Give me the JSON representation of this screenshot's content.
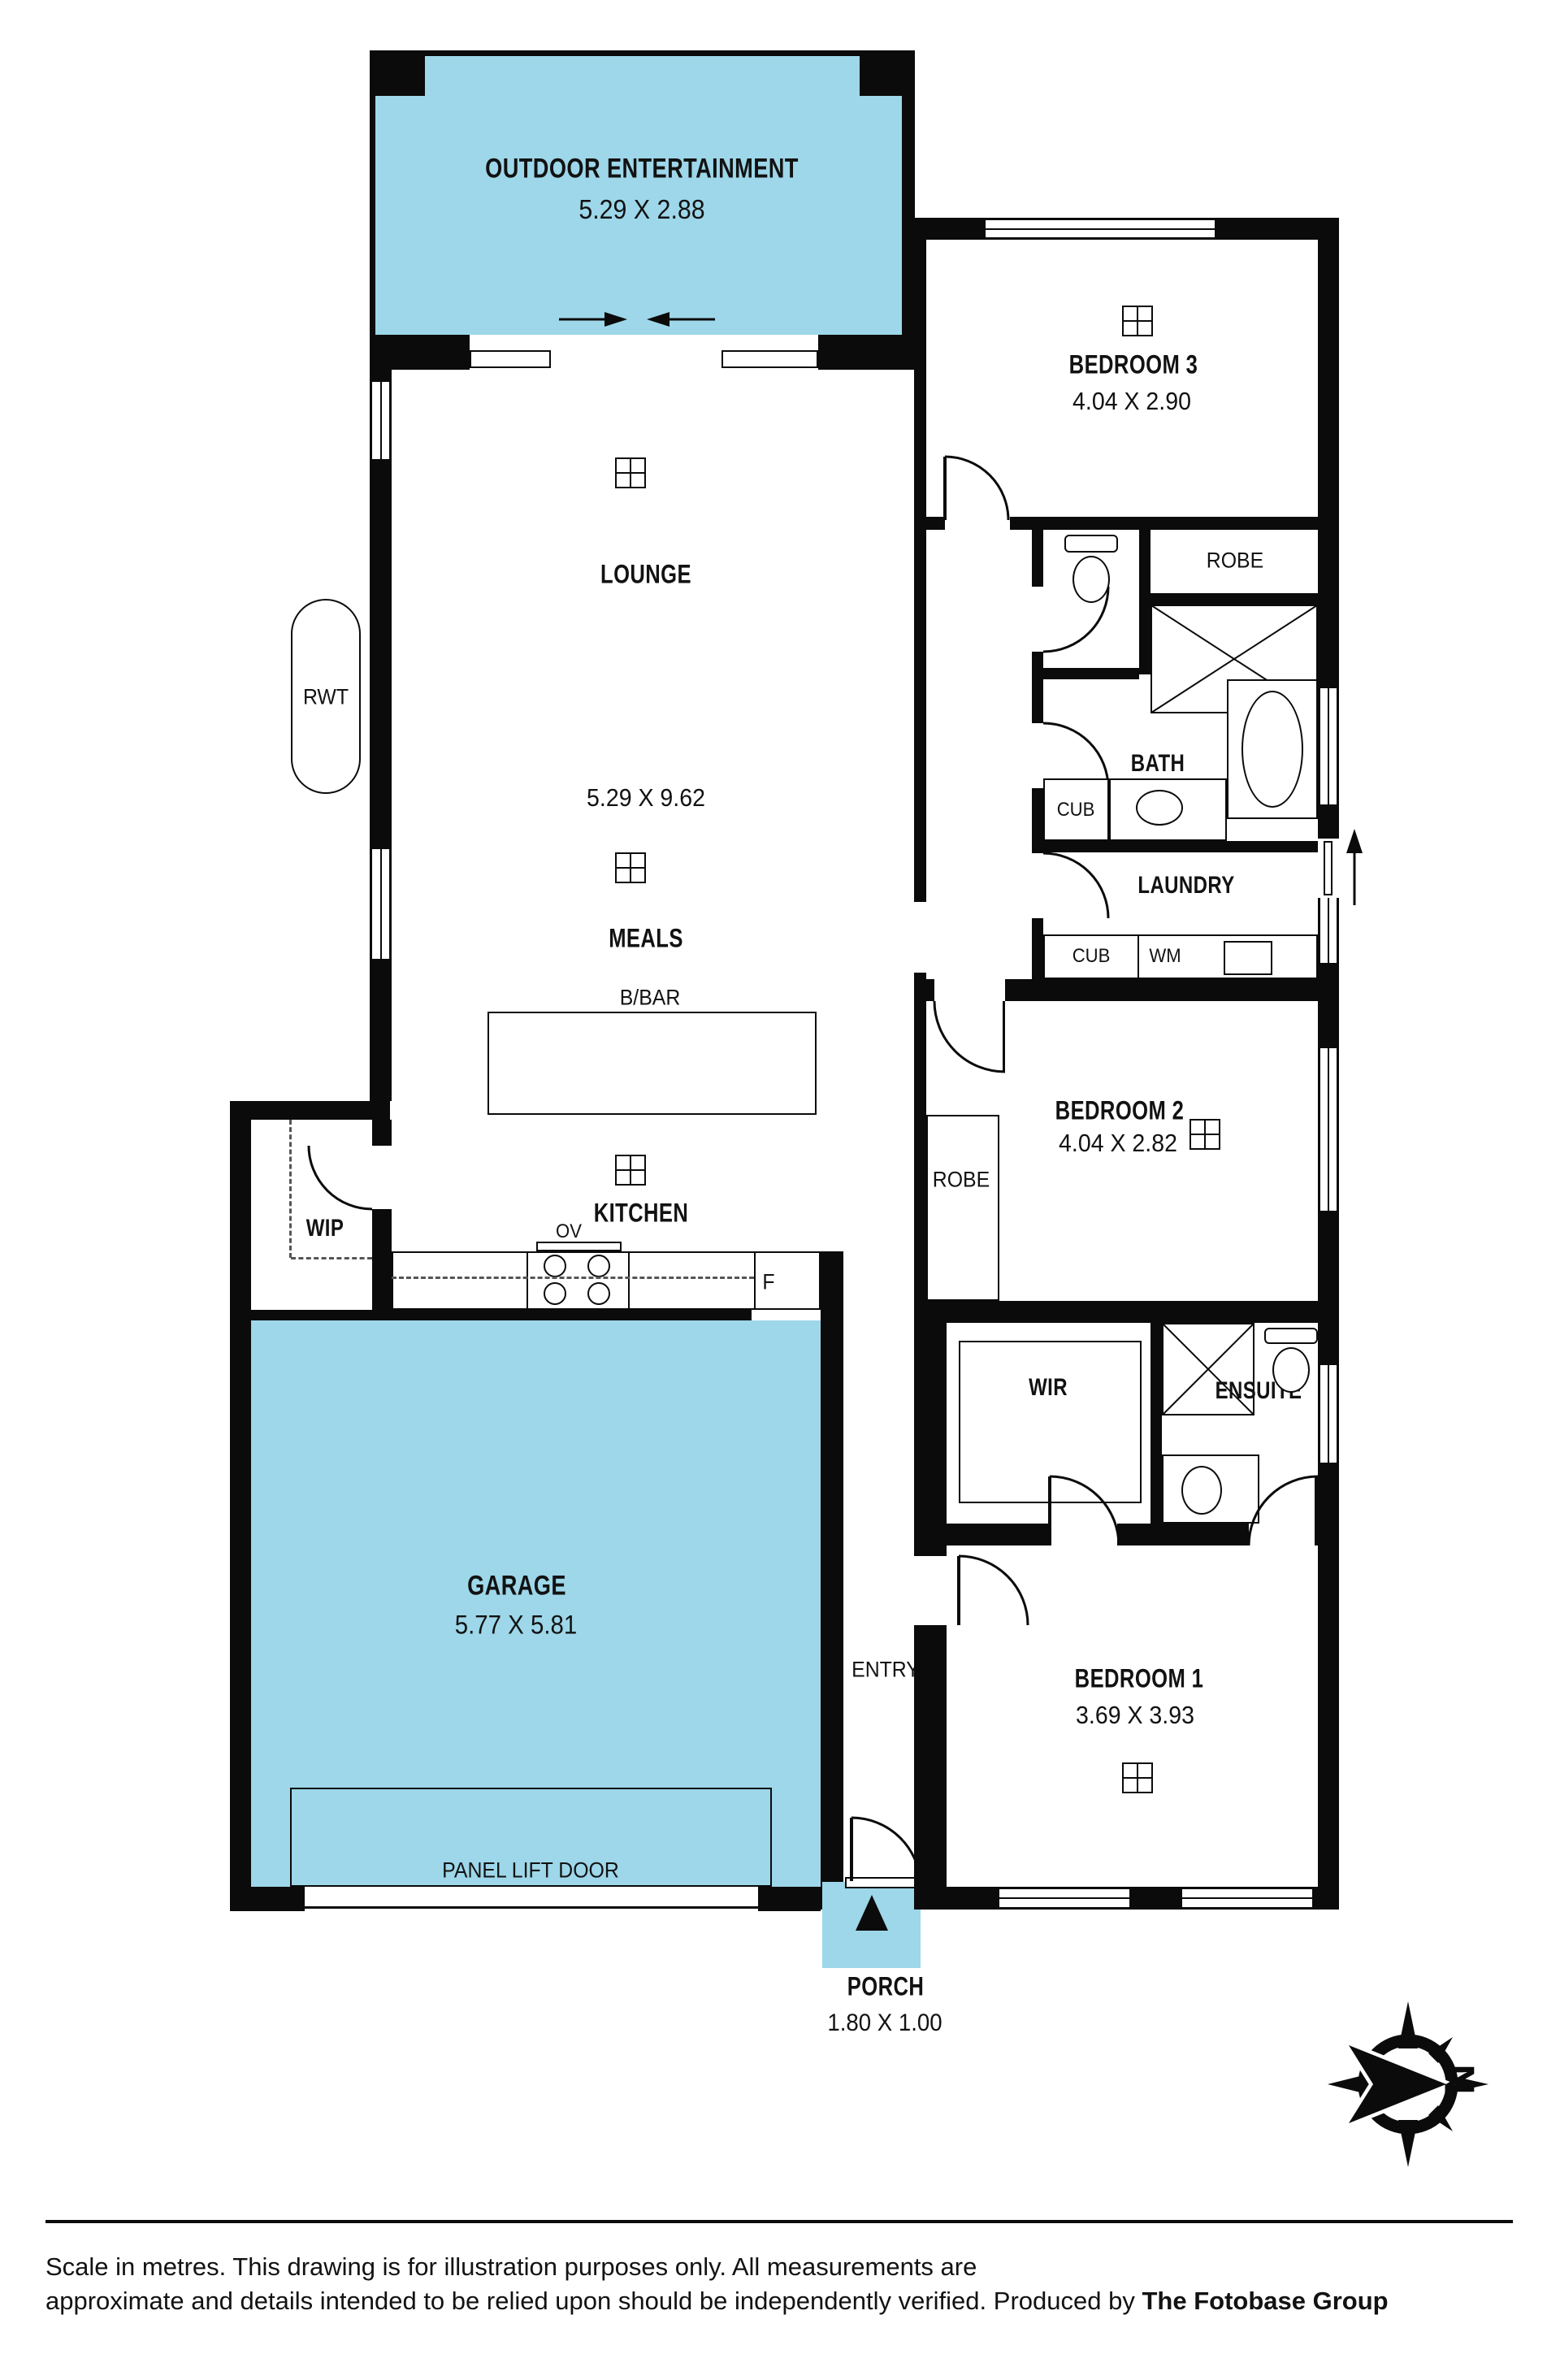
{
  "colors": {
    "room_fill": "#9dd7e9",
    "wall": "#0b0b0b",
    "background": "#ffffff"
  },
  "rooms": {
    "outdoor": {
      "name": "OUTDOOR ENTERTAINMENT",
      "dims": "5.29 X 2.88"
    },
    "lounge": {
      "name": "LOUNGE",
      "dims": "5.29 X 9.62"
    },
    "meals": {
      "name": "MEALS"
    },
    "kitchen": {
      "name": "KITCHEN"
    },
    "wip": {
      "name": "WIP"
    },
    "garage": {
      "name": "GARAGE",
      "dims": "5.77 X 5.81"
    },
    "entry": {
      "name": "ENTRY"
    },
    "porch": {
      "name": "PORCH",
      "dims": "1.80 X 1.00"
    },
    "bedroom1": {
      "name": "BEDROOM 1",
      "dims": "3.69 X 3.93"
    },
    "bedroom2": {
      "name": "BEDROOM 2",
      "dims": "4.04 X 2.82"
    },
    "bedroom3": {
      "name": "BEDROOM 3",
      "dims": "4.04 X 2.90"
    },
    "wir": {
      "name": "WIR"
    },
    "ensuite": {
      "name": "ENSUITE"
    },
    "bath": {
      "name": "BATH"
    },
    "laundry": {
      "name": "LAUNDRY"
    }
  },
  "fixtures": {
    "bbar": "B/BAR",
    "oven": "OV",
    "fridge": "F",
    "rwt": "RWT",
    "robe_bed3": "ROBE",
    "robe_bed2": "ROBE",
    "cub_bath": "CUB",
    "cub_laundry": "CUB",
    "wm": "WM",
    "panel_lift_door": "PANEL LIFT DOOR"
  },
  "symbols": {
    "north": "N"
  },
  "footer": {
    "line1": "Scale in metres. This drawing is for illustration purposes only. All measurements are",
    "line2": "approximate and details intended to be relied upon should be independently verified.",
    "produced_by": "Produced by",
    "brand": "The Fotobase Group"
  }
}
